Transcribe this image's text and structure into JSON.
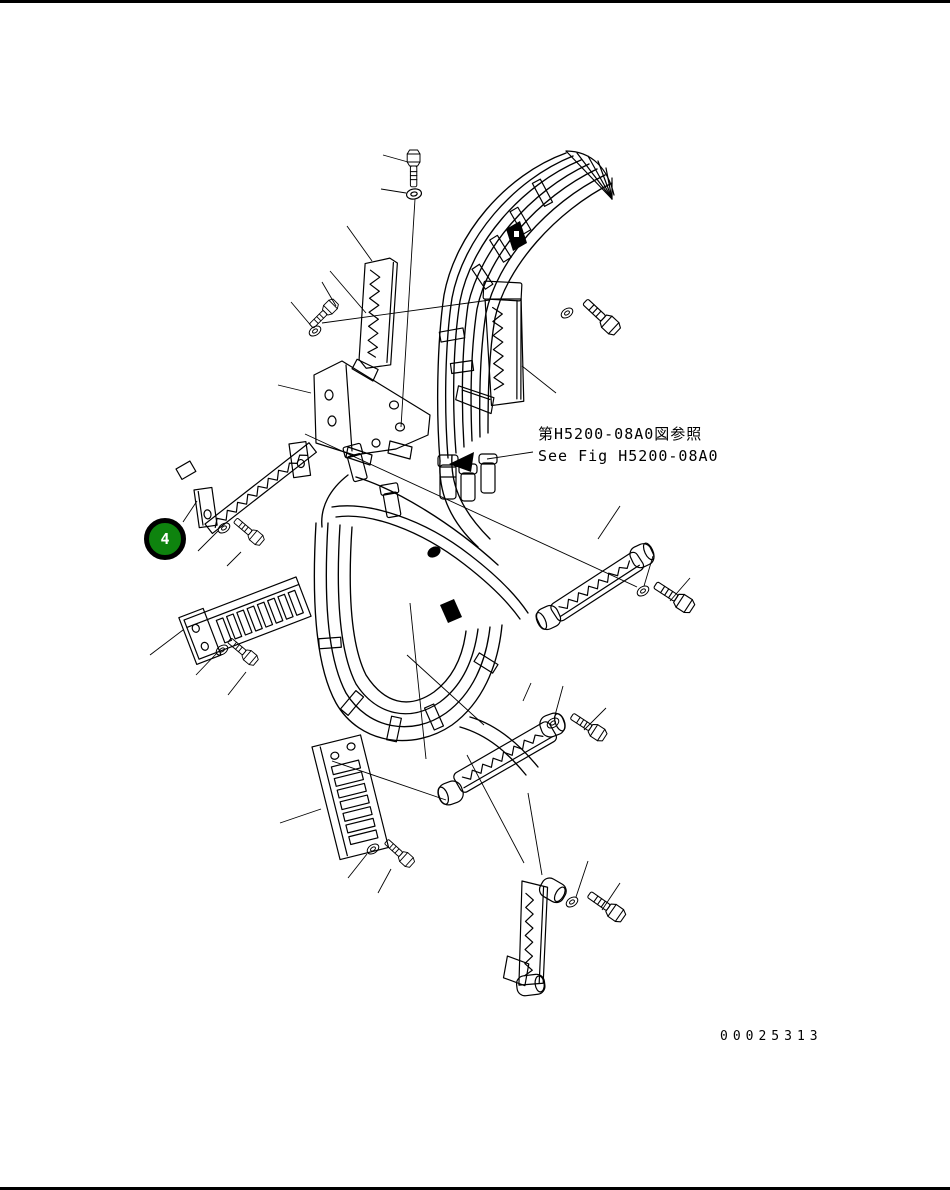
{
  "page": {
    "background_color": "#ffffff",
    "drawing_color": "#000000"
  },
  "balloon": {
    "label": "4",
    "fill_color": "#0e830e",
    "ring_color": "#000000",
    "label_color": "#ffffff"
  },
  "reference_note": {
    "japanese": "第H5200-08A0図参照",
    "english": "See Fig H5200-08A0"
  },
  "footer": {
    "document_number": "00025313"
  },
  "drawing": {
    "name": "hydraulic-hose-clamp-exploded-diagram",
    "depicted_parts": [
      "hose-bundle",
      "serrated-clamp",
      "ladder-clamp-plate",
      "mounting-bracket",
      "hex-bolt",
      "washer",
      "leader-arrow"
    ]
  }
}
